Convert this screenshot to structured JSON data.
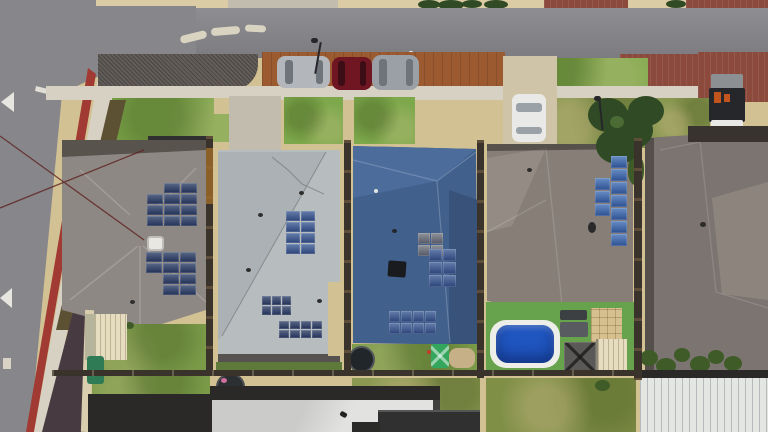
{
  "scene": {
    "type": "aerial-photo",
    "description": "Top-down aerial drone photo of a suburban street: five houses with tiled roofs and rooftop solar arrays, a horizontal road at top with three parked cars on a rust-coloured parking bay, a diagonal road with a red edge lane and white arrows on the left, green lawns, a backyard swimming pool on artificial turf, a trampoline, sheds, a gazebo and a white corrugated patio roof",
    "setting": "residential neighbourhood, bright midday sun"
  },
  "road": {
    "markings": [
      "white lane arrows",
      "red painted edge lane",
      "traffic island kerbs",
      "road reflector"
    ],
    "street_furniture": [
      "street light",
      "street light",
      "power lines",
      "street tree"
    ]
  },
  "vehicles": [
    {
      "type": "car",
      "color": "silver",
      "location": "street parking bay"
    },
    {
      "type": "car",
      "color": "dark red",
      "location": "street parking bay"
    },
    {
      "type": "suv",
      "color": "silver grey",
      "location": "street parking bay"
    },
    {
      "type": "car",
      "color": "white",
      "location": "driveway"
    },
    {
      "type": "trailer with orange gear",
      "color": "black",
      "location": "brick driveway"
    }
  ],
  "houses": [
    {
      "id": 1,
      "roof": "grey-taupe tiles",
      "solar_panels": 21,
      "features": [
        "white roof unit",
        "rear lawn",
        "cream shed",
        "green bin"
      ]
    },
    {
      "id": 2,
      "roof": "pale grey metal",
      "solar_panels": 22,
      "features": [
        "concrete driveway",
        "rust-streaked side fence"
      ]
    },
    {
      "id": 3,
      "roof": "steel blue tiles",
      "solar_panels": 18,
      "features": [
        "trampoline",
        "green clothesline",
        "rear lawn"
      ]
    },
    {
      "id": 4,
      "roof": "taupe tiles",
      "solar_panels": 10,
      "features": [
        "swimming pool",
        "artificial turf",
        "gazebo",
        "cream shed",
        "paved square"
      ]
    },
    {
      "id": 5,
      "roof": "dark taupe tiles",
      "solar_panels": 0,
      "features": [
        "white corrugated patio roof",
        "hedge row"
      ]
    }
  ],
  "pool": {
    "water_color": "deep blue",
    "surround": "white coping on bright green turf"
  },
  "solar_arrays": [
    {
      "house": 1,
      "x": 147,
      "y": 183,
      "cols": 3,
      "rows": 4,
      "pw": 16,
      "ph": 10,
      "gap": 1,
      "color": "panelNavy",
      "skip": [
        0
      ]
    },
    {
      "house": 1,
      "x": 146,
      "y": 252,
      "cols": 3,
      "rows": 4,
      "pw": 16,
      "ph": 10,
      "gap": 1,
      "color": "panelNavy",
      "skip": [
        6,
        9
      ]
    },
    {
      "house": 2,
      "x": 286,
      "y": 211,
      "cols": 2,
      "rows": 4,
      "pw": 14,
      "ph": 10,
      "gap": 1,
      "color": "panelBlue",
      "skip": []
    },
    {
      "house": 2,
      "x": 262,
      "y": 296,
      "cols": 3,
      "rows": 2,
      "pw": 9,
      "ph": 9,
      "gap": 1,
      "color": "panelNavy",
      "skip": []
    },
    {
      "house": 2,
      "x": 279,
      "y": 321,
      "cols": 4,
      "rows": 2,
      "pw": 10,
      "ph": 8,
      "gap": 1,
      "color": "panelNavy",
      "skip": []
    },
    {
      "house": 3,
      "x": 418,
      "y": 233,
      "cols": 2,
      "rows": 2,
      "pw": 12,
      "ph": 11,
      "gap": 1,
      "color": "panelGray",
      "skip": []
    },
    {
      "house": 3,
      "x": 429,
      "y": 249,
      "cols": 2,
      "rows": 3,
      "pw": 13,
      "ph": 12,
      "gap": 1,
      "color": "panelBlue",
      "skip": []
    },
    {
      "house": 3,
      "x": 389,
      "y": 311,
      "cols": 4,
      "rows": 2,
      "pw": 11,
      "ph": 11,
      "gap": 1,
      "color": "panelBlue",
      "skip": []
    },
    {
      "house": 4,
      "x": 611,
      "y": 156,
      "cols": 1,
      "rows": 7,
      "pw": 16,
      "ph": 12,
      "gap": 1,
      "color": "panelBright",
      "skip": []
    },
    {
      "house": 4,
      "x": 595,
      "y": 178,
      "cols": 1,
      "rows": 3,
      "pw": 15,
      "ph": 12,
      "gap": 1,
      "color": "panelBright",
      "skip": []
    }
  ],
  "palette": {
    "sand": "#d2c193",
    "sandLight": "#dbcca5",
    "road": "#87868b",
    "gravel": "#635d5a",
    "sidewalk": "#d7d1c3",
    "redLane": "#a03a33",
    "brick": "#8c4a3d",
    "parkingBay": "#9c5a31",
    "grass": "#7da84b",
    "grassOlive": "#8a9851",
    "lawn": "#7a9a48",
    "lawnDry": "#7f8f46",
    "turf": "#67a24c",
    "treeDark": "#2f4a24",
    "shrub": "#3e5b28",
    "hedgeDry": "#5d5133",
    "mulch": "#483a41",
    "fence": "#3a332c",
    "roof1": "#8e8884",
    "roof1Eave": "#59534e",
    "roof2": "#b7bcbe",
    "roof3": "#41608c",
    "roof3Light": "#4c6c9c",
    "roof3Dark": "#38527a",
    "roof4": "#867e77",
    "roof4Light": "#948c84",
    "roof5": "#7b7470",
    "roof5Light": "#8d857d",
    "roofWhite": "#d8d9d7",
    "roofBlack": "#303030",
    "corrugated": "#e4e6e4",
    "panelNavy": "#2c3f66",
    "panelBlue": "#3a5a94",
    "panelGray": "#70757c",
    "panelBright": "#3c6cb4",
    "poolWater": "#2056c0",
    "poolCoping": "#edeee8",
    "carSilver": "#b3b7bb",
    "carRed": "#6f1622",
    "carSuv": "#9aa0a5",
    "carWhite": "#e9eae8",
    "glassDark": "#6f747a",
    "trailerDark": "#25272a",
    "trailerOrange": "#c2551e",
    "trailerWhite": "#e8e8e6",
    "shedCream": "#e6dcc0",
    "gazebo": "#5b5957",
    "binGreen": "#2e7b55",
    "playGreen": "#35a65e",
    "pavers": "#d7c08f",
    "ac": "#e9e7e1",
    "white": "#f5f5f2",
    "powerline": "#5e2220",
    "dirt": "#c6b088",
    "darkBand": "#2b2927",
    "wallCream": "#d9cfae",
    "driveway": "#cfc4a8",
    "drivewayGrey": "#c2bcae",
    "island": "#d9d3c1",
    "poleDark": "#26262a",
    "eaveDark": "#565250",
    "trampoline": "#21262a",
    "furnitureDark": "#3c4043",
    "furnitureGrey": "#585c60"
  }
}
